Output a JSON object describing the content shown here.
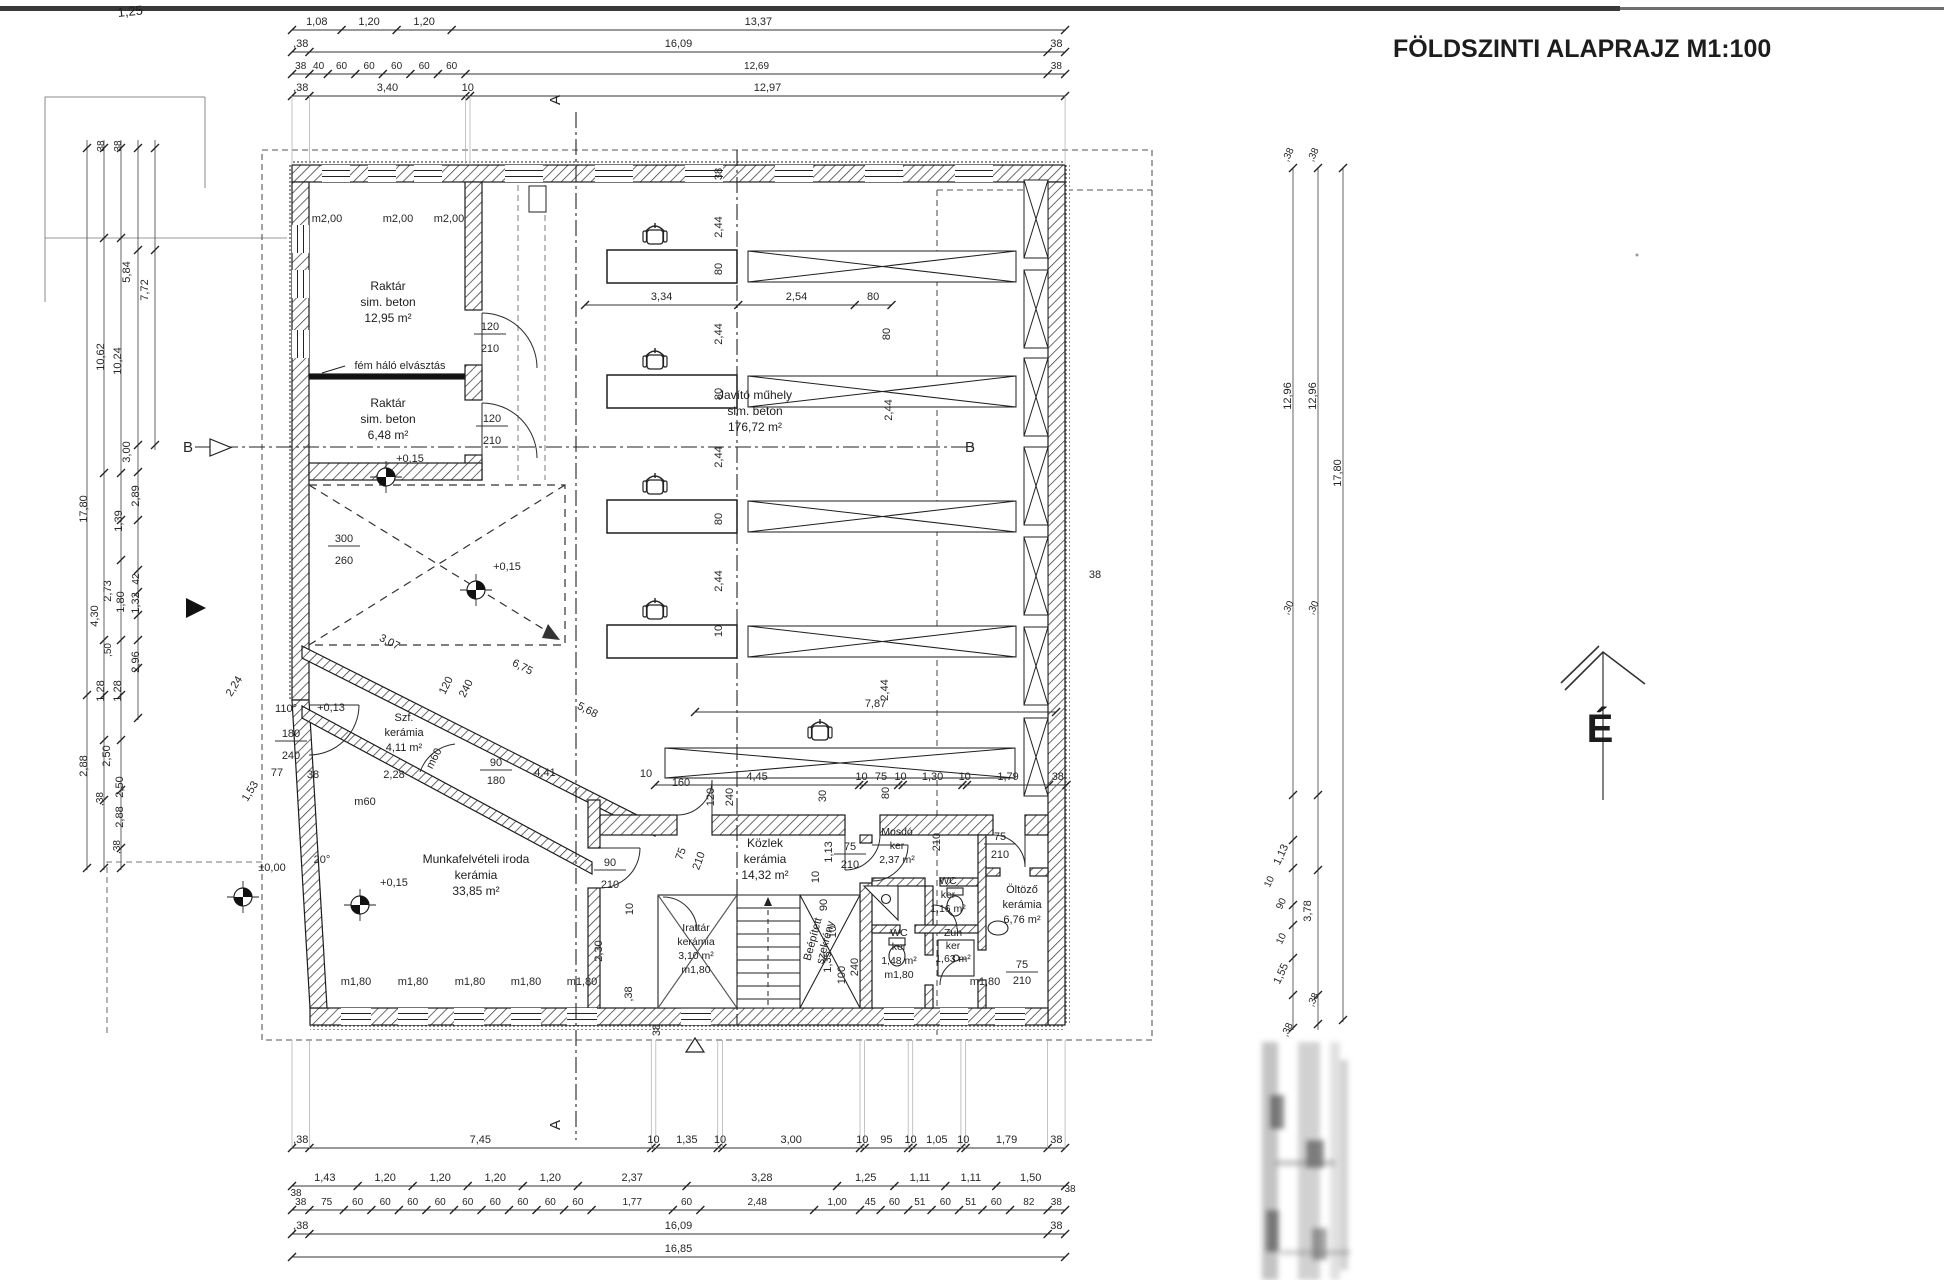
{
  "title": "FÖLDSZINTI ALAPRAJZ M1:100",
  "north": {
    "label": "É"
  },
  "handwriting": "1,25",
  "rooms": [
    {
      "name": "raktar-1",
      "lines": [
        "Raktár",
        "sim. beton",
        "12,95 m²"
      ],
      "cx": 388,
      "cy": 290
    },
    {
      "name": "raktar-2",
      "lines": [
        "Raktár",
        "sim. beton",
        "6,48 m²"
      ],
      "cx": 388,
      "cy": 407
    },
    {
      "name": "javito-muhely",
      "lines": [
        "Javító műhely",
        "sim. beton",
        "176,72 m²"
      ],
      "cx": 755,
      "cy": 399
    },
    {
      "name": "munkafelveteli-iroda",
      "lines": [
        "Munkafelvételi iroda",
        "kerámia",
        "33,85 m²"
      ],
      "cx": 476,
      "cy": 863
    },
    {
      "name": "kozlekedo",
      "lines": [
        "Közlek",
        "kerámia",
        "14,32 m²"
      ],
      "cx": 765,
      "cy": 847
    },
    {
      "name": "szelfogo",
      "lines": [
        "Szf.",
        "kerámia",
        "4,11 m²"
      ],
      "cx": 404,
      "cy": 721,
      "s": 11,
      "lh": 15
    },
    {
      "name": "irattar",
      "lines": [
        "Irattár",
        "kerámia",
        "3,10 m²",
        "m1,80"
      ],
      "cx": 696,
      "cy": 931,
      "s": 10.5,
      "lh": 14
    },
    {
      "name": "mosdo",
      "lines": [
        "Mosdó",
        "ker",
        "2,37 m²"
      ],
      "cx": 897,
      "cy": 835,
      "s": 10.5,
      "lh": 14
    },
    {
      "name": "wc-1",
      "lines": [
        "WC",
        "ker",
        "1,16 m²"
      ],
      "cx": 948,
      "cy": 884,
      "s": 10.5,
      "lh": 14
    },
    {
      "name": "oltozo",
      "lines": [
        "Öltöző",
        "kerámia",
        "6,76 m²"
      ],
      "cx": 1022,
      "cy": 893,
      "s": 11,
      "lh": 15
    },
    {
      "name": "wc-2",
      "lines": [
        "WC",
        "ker",
        "1,48 m²",
        "m1,80"
      ],
      "cx": 899,
      "cy": 936,
      "s": 10.5,
      "lh": 14
    },
    {
      "name": "zuhanyzo",
      "lines": [
        "Zuh",
        "ker",
        "1,63 m²"
      ],
      "cx": 953,
      "cy": 936,
      "s": 10.5,
      "lh": 13
    },
    {
      "name": "beepitett-szekreny",
      "lines": [
        "Beépített",
        "szekrény"
      ],
      "cx": 816,
      "cy": 940,
      "s": 11,
      "lh": 13,
      "r": -75
    }
  ],
  "dim_chains": [
    {
      "id": "top-1",
      "y": 30,
      "x0": 292,
      "values": [
        "1,08",
        "1,20",
        "1,20",
        "13,37"
      ]
    },
    {
      "id": "top-2",
      "y": 52,
      "x0": 292,
      "values": [
        ",38",
        "16,09",
        "38"
      ]
    },
    {
      "id": "top-3",
      "y": 74,
      "x0": 292,
      "s": 10,
      "values": [
        "38",
        "40",
        "60",
        "60",
        "60",
        "60",
        "60",
        "12,69",
        "38"
      ]
    },
    {
      "id": "top-4",
      "y": 96,
      "x0": 292,
      "ext": 165,
      "values": [
        ",38",
        "3,40",
        "10",
        "12,97"
      ]
    },
    {
      "id": "workshop-width",
      "y": 305,
      "x0": 585,
      "values": [
        "3,34",
        "2,54",
        "80"
      ]
    },
    {
      "id": "workshop-787",
      "y": 712,
      "x0": 695,
      "values": [
        "7,87"
      ]
    },
    {
      "id": "wetrooms-row",
      "y": 785,
      "x0": 655,
      "values": [
        "4,45",
        "10",
        "75",
        "10",
        "1,30",
        "10",
        "1,79",
        "38"
      ]
    },
    {
      "id": "bottom-1",
      "y": 1148,
      "x0": 292,
      "ext": 1040,
      "values": [
        ",38",
        "7,45",
        "10",
        "1,35",
        "10",
        "3,00",
        "10",
        "95",
        "10",
        "1,05",
        "10",
        "1,79",
        "38"
      ]
    },
    {
      "id": "bottom-2",
      "y": 1186,
      "x0": 292,
      "values": [
        "1,43",
        "1,20",
        "1,20",
        "1,20",
        "1,20",
        "2,37",
        "3,28",
        "1,25",
        "1,11",
        "1,11",
        "1,50"
      ]
    },
    {
      "id": "bottom-3",
      "y": 1210,
      "x0": 292,
      "s": 10,
      "values": [
        "38",
        "75",
        "60",
        "60",
        "60",
        "60",
        "60",
        "60",
        "60",
        "60",
        "60",
        "1,77",
        "60",
        "2,48",
        "1,00",
        "45",
        "60",
        "51",
        "60",
        "51",
        "60",
        "82",
        "38"
      ]
    },
    {
      "id": "bottom-4",
      "y": 1234,
      "x0": 292,
      "values": [
        ",38",
        "16,09",
        "38"
      ]
    },
    {
      "id": "bottom-5",
      "y": 1257,
      "x0": 292,
      "values": [
        "16,85"
      ]
    }
  ],
  "labels": [
    {
      "t": "m2,00",
      "x": 327,
      "y": 222
    },
    {
      "t": "m2,00",
      "x": 398,
      "y": 222
    },
    {
      "t": "m2,00",
      "x": 449,
      "y": 222
    },
    {
      "t": "fém háló elvásztás",
      "x": 400,
      "y": 369
    },
    {
      "t": "120",
      "x": 490,
      "y": 330,
      "bar": 1
    },
    {
      "t": "210",
      "x": 490,
      "y": 352
    },
    {
      "t": "120",
      "x": 492,
      "y": 422,
      "bar": 1
    },
    {
      "t": "210",
      "x": 492,
      "y": 444
    },
    {
      "t": "300",
      "x": 344,
      "y": 542,
      "bar": 1
    },
    {
      "t": "260",
      "x": 344,
      "y": 564
    },
    {
      "t": "180",
      "x": 291,
      "y": 737,
      "bar": 1
    },
    {
      "t": "240",
      "x": 291,
      "y": 759
    },
    {
      "t": "90",
      "x": 610,
      "y": 866,
      "bar": 1
    },
    {
      "t": "210",
      "x": 610,
      "y": 888
    },
    {
      "t": "75",
      "x": 850,
      "y": 850,
      "bar": 1
    },
    {
      "t": "210",
      "x": 850,
      "y": 868
    },
    {
      "t": "75",
      "x": 1000,
      "y": 840,
      "bar": 1
    },
    {
      "t": "210",
      "x": 1000,
      "y": 858
    },
    {
      "t": "75",
      "x": 1022,
      "y": 968,
      "bar": 1
    },
    {
      "t": "210",
      "x": 1022,
      "y": 984
    },
    {
      "t": "90",
      "x": 496,
      "y": 766,
      "bar": 1
    },
    {
      "t": "180",
      "x": 496,
      "y": 784
    },
    {
      "t": "75",
      "x": 684,
      "y": 855,
      "r": -70
    },
    {
      "t": "210",
      "x": 702,
      "y": 862,
      "r": -70
    },
    {
      "t": "+0,15",
      "x": 410,
      "y": 462
    },
    {
      "t": "+0,15",
      "x": 507,
      "y": 570
    },
    {
      "t": "+0,15",
      "x": 394,
      "y": 886
    },
    {
      "t": "±0,00",
      "x": 272,
      "y": 871
    },
    {
      "t": "+0,13",
      "x": 331,
      "y": 711
    },
    {
      "t": "110°",
      "x": 286,
      "y": 712
    },
    {
      "t": "20°",
      "x": 322,
      "y": 863
    },
    {
      "t": "3,07",
      "x": 388,
      "y": 645,
      "r": 27
    },
    {
      "t": "6,75",
      "x": 521,
      "y": 670,
      "r": 27
    },
    {
      "t": "5,68",
      "x": 586,
      "y": 713,
      "r": 27
    },
    {
      "t": "2,28",
      "x": 394,
      "y": 778
    },
    {
      "t": "2,24",
      "x": 237,
      "y": 688,
      "r": -58
    },
    {
      "t": "1,53",
      "x": 253,
      "y": 793,
      "r": -58
    },
    {
      "t": "77",
      "x": 277,
      "y": 776
    },
    {
      "t": "38",
      "x": 313,
      "y": 778
    },
    {
      "t": "m60",
      "x": 365,
      "y": 805
    },
    {
      "t": "m60",
      "x": 437,
      "y": 760,
      "r": -63
    },
    {
      "t": "120",
      "x": 449,
      "y": 687,
      "r": -63
    },
    {
      "t": "240",
      "x": 469,
      "y": 690,
      "r": -63
    },
    {
      "t": "4,41",
      "x": 545,
      "y": 776
    },
    {
      "t": "10",
      "x": 646,
      "y": 777
    },
    {
      "t": "160",
      "x": 681,
      "y": 786
    },
    {
      "t": "120",
      "x": 714,
      "y": 797,
      "r": -90
    },
    {
      "t": "240",
      "x": 733,
      "y": 797,
      "r": -90
    },
    {
      "t": "30",
      "x": 826,
      "y": 796,
      "r": -90
    },
    {
      "t": "80",
      "x": 889,
      "y": 793,
      "r": -90
    },
    {
      "t": "1,13",
      "x": 832,
      "y": 852,
      "r": -90
    },
    {
      "t": "10",
      "x": 819,
      "y": 877,
      "r": -90
    },
    {
      "t": "210",
      "x": 940,
      "y": 842,
      "r": -90
    },
    {
      "t": "38",
      "x": 722,
      "y": 174,
      "r": -90
    },
    {
      "t": "2,44",
      "x": 722,
      "y": 227,
      "r": -90
    },
    {
      "t": "80",
      "x": 722,
      "y": 269,
      "r": -90
    },
    {
      "t": "2,44",
      "x": 722,
      "y": 334,
      "r": -90
    },
    {
      "t": "80",
      "x": 722,
      "y": 394,
      "r": -90
    },
    {
      "t": "2,44",
      "x": 722,
      "y": 457,
      "r": -90
    },
    {
      "t": "80",
      "x": 722,
      "y": 519,
      "r": -90
    },
    {
      "t": "2,44",
      "x": 722,
      "y": 581,
      "r": -90
    },
    {
      "t": "10",
      "x": 722,
      "y": 631,
      "r": -90
    },
    {
      "t": "80",
      "x": 890,
      "y": 334,
      "r": -90
    },
    {
      "t": "2,44",
      "x": 892,
      "y": 410,
      "r": -90
    },
    {
      "t": "2,44",
      "x": 888,
      "y": 690,
      "r": -90
    },
    {
      "t": "38",
      "x": 1095,
      "y": 578
    },
    {
      "t": "90",
      "x": 827,
      "y": 905,
      "r": -90
    },
    {
      "t": "10",
      "x": 836,
      "y": 932,
      "r": -90
    },
    {
      "t": "1,35",
      "x": 831,
      "y": 962,
      "r": -90
    },
    {
      "t": "100",
      "x": 845,
      "y": 975,
      "r": -90
    },
    {
      "t": "240",
      "x": 858,
      "y": 967,
      "r": -90
    },
    {
      "t": "10",
      "x": 633,
      "y": 909,
      "r": -90
    },
    {
      "t": "2,30",
      "x": 602,
      "y": 951,
      "r": -90
    },
    {
      "t": ",38",
      "x": 632,
      "y": 994,
      "r": -90
    },
    {
      "t": "38",
      "x": 660,
      "y": 1030,
      "r": -90
    },
    {
      "t": "m1,80",
      "x": 356,
      "y": 985
    },
    {
      "t": "m1,80",
      "x": 413,
      "y": 985
    },
    {
      "t": "m1,80",
      "x": 470,
      "y": 985
    },
    {
      "t": "m1,80",
      "x": 526,
      "y": 985
    },
    {
      "t": "m1,80",
      "x": 582,
      "y": 985
    },
    {
      "t": "m1,80",
      "x": 985,
      "y": 985
    },
    {
      "t": "38",
      "x": 104,
      "y": 146,
      "r": -90,
      "s": 10
    },
    {
      "t": "38",
      "x": 121,
      "y": 146,
      "r": -90,
      "s": 10
    },
    {
      "t": "5,84",
      "x": 130,
      "y": 272,
      "r": -90
    },
    {
      "t": "7,72",
      "x": 148,
      "y": 290,
      "r": -90
    },
    {
      "t": "10,62",
      "x": 104,
      "y": 357,
      "r": -90
    },
    {
      "t": "10,24",
      "x": 121,
      "y": 361,
      "r": -90
    },
    {
      "t": "3,00",
      "x": 130,
      "y": 452,
      "r": -90
    },
    {
      "t": "2,89",
      "x": 139,
      "y": 496,
      "r": -90
    },
    {
      "t": "17,80",
      "x": 87,
      "y": 509,
      "r": -90
    },
    {
      "t": "1,39",
      "x": 122,
      "y": 521,
      "r": -90
    },
    {
      "t": "42",
      "x": 139,
      "y": 579,
      "r": -90,
      "s": 10
    },
    {
      "t": "2,73",
      "x": 111,
      "y": 591,
      "r": -90
    },
    {
      "t": "1,80",
      "x": 124,
      "y": 602,
      "r": -90
    },
    {
      "t": "1,32",
      "x": 139,
      "y": 603,
      "r": -90
    },
    {
      "t": "4,30",
      "x": 98,
      "y": 616,
      "r": -90
    },
    {
      "t": ",50",
      "x": 111,
      "y": 650,
      "r": -90,
      "s": 10
    },
    {
      "t": "2,96",
      "x": 139,
      "y": 662,
      "r": -90
    },
    {
      "t": "1,28",
      "x": 104,
      "y": 691,
      "r": -90
    },
    {
      "t": "1,28",
      "x": 121,
      "y": 691,
      "r": -90
    },
    {
      "t": "2,50",
      "x": 110,
      "y": 756,
      "r": -90
    },
    {
      "t": "2,50",
      "x": 123,
      "y": 787,
      "r": -90
    },
    {
      "t": "2,88",
      "x": 87,
      "y": 766,
      "r": -90
    },
    {
      "t": "2,88",
      "x": 123,
      "y": 817,
      "r": -90
    },
    {
      "t": ",38",
      "x": 103,
      "y": 799,
      "r": -90,
      "s": 10
    },
    {
      "t": ",38",
      "x": 120,
      "y": 847,
      "r": -90,
      "s": 10
    },
    {
      "t": ",38",
      "x": 1291,
      "y": 156,
      "r": -65,
      "s": 10
    },
    {
      "t": ",38",
      "x": 1316,
      "y": 156,
      "r": -65,
      "s": 10
    },
    {
      "t": "12,96",
      "x": 1291,
      "y": 396,
      "r": -90
    },
    {
      "t": "12,96",
      "x": 1316,
      "y": 396,
      "r": -90
    },
    {
      "t": "17,80",
      "x": 1341,
      "y": 473,
      "r": -90
    },
    {
      "t": ",30",
      "x": 1291,
      "y": 609,
      "r": -65,
      "s": 10
    },
    {
      "t": ",30",
      "x": 1316,
      "y": 609,
      "r": -65,
      "s": 10
    },
    {
      "t": "1,13",
      "x": 1284,
      "y": 856,
      "r": -65
    },
    {
      "t": "10",
      "x": 1272,
      "y": 883,
      "r": -65,
      "s": 10
    },
    {
      "t": "90",
      "x": 1284,
      "y": 905,
      "r": -65,
      "s": 10
    },
    {
      "t": "3,78",
      "x": 1311,
      "y": 911,
      "r": -90
    },
    {
      "t": "10",
      "x": 1284,
      "y": 940,
      "r": -65,
      "s": 10
    },
    {
      "t": "1,55",
      "x": 1284,
      "y": 975,
      "r": -65
    },
    {
      "t": ",38",
      "x": 1316,
      "y": 1001,
      "r": -65,
      "s": 10
    },
    {
      "t": ",38",
      "x": 1290,
      "y": 1031,
      "r": -65,
      "s": 10
    },
    {
      "t": "B",
      "x": 188,
      "y": 452,
      "s": 15
    },
    {
      "t": "B",
      "x": 970,
      "y": 452,
      "s": 15
    },
    {
      "t": "A",
      "x": 560,
      "y": 100,
      "s": 15,
      "r": -90
    },
    {
      "t": "A",
      "x": 560,
      "y": 1125,
      "s": 15,
      "r": -90
    },
    {
      "t": "38",
      "x": 296,
      "y": 1196,
      "s": 10
    },
    {
      "t": "38",
      "x": 1070,
      "y": 1192,
      "s": 10
    }
  ]
}
